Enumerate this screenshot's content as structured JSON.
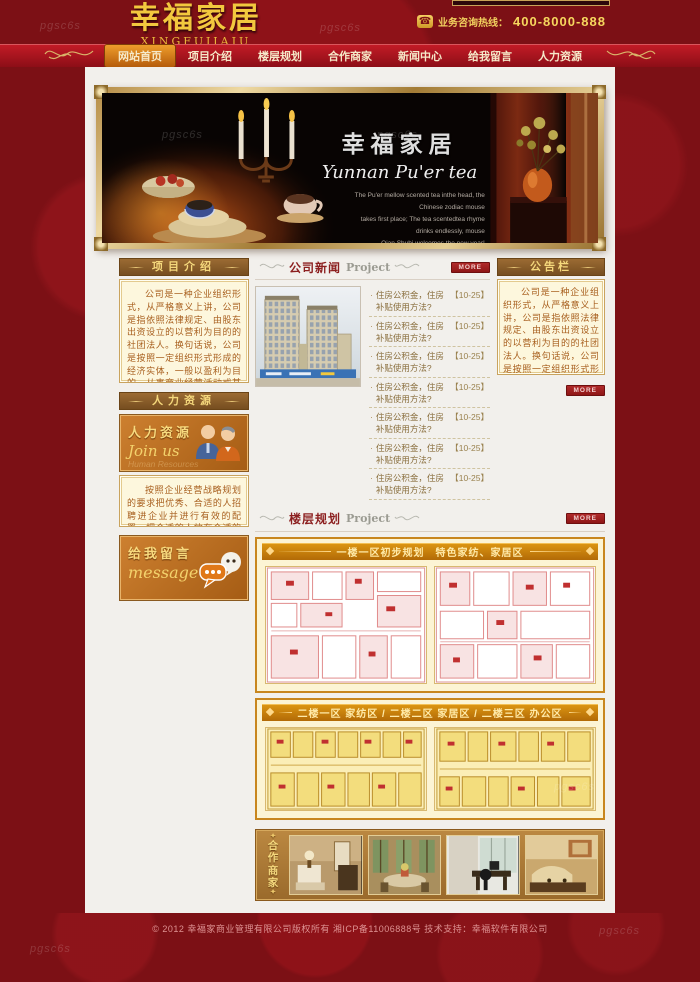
{
  "watermark": "pgsc6s",
  "header": {
    "logo_title": "幸福家居",
    "logo_subtitle": "XINGFUJIAJU",
    "phone_icon": "phone-icon",
    "hotline_label": "业务咨询热线：",
    "hotline_number": "400-8000-888"
  },
  "nav": {
    "items": [
      {
        "label": "网站首页",
        "active": true
      },
      {
        "label": "项目介绍",
        "active": false
      },
      {
        "label": "楼层规划",
        "active": false
      },
      {
        "label": "合作商家",
        "active": false
      },
      {
        "label": "新闻中心",
        "active": false
      },
      {
        "label": "给我留言",
        "active": false
      },
      {
        "label": "人力资源",
        "active": false
      }
    ]
  },
  "banner": {
    "title": "幸福家居",
    "subtitle": "Yunnan Pu'er tea",
    "lines": [
      "The Pu'er mellow scented tea inthe head, the",
      "Chinese zodiac mouse",
      "takes first place; The tea scentedtea rhyme",
      "drinks endlessly, mouse",
      "Qian Shubi welcomes the new year!"
    ]
  },
  "left": {
    "intro_title": "项目介绍",
    "intro_body": "公司是一种企业组织形式，从严格意义上讲，公司是指依照法律规定、由股东出资设立的以营利为目的的社团法人。换句话说，公司是按照一定组织形式形成的经济实体，一般以盈利为目的，从事商业经营活动或某些目的而成立的组织，以实现投资人利益最大化为使命，通过提供产品或服务换取收入。它是社会",
    "hr_title": "人力资源",
    "join_title": "人力资源",
    "join_subtitle": "Join us",
    "join_ghost": "Human Resources",
    "hr_body": "按照企业经营战略规划的要求把优秀、合适的人招聘进企业并进行有效的配置，把合适的人放在合适的岗位。工作内容...",
    "message_title": "给我留言",
    "message_subtitle": "message"
  },
  "news": {
    "title": "公司新闻",
    "title_en": "Project",
    "more_label": "MORE",
    "items": [
      {
        "text": "住房公积金，住房补贴使用方法?",
        "date": "【10-25】"
      },
      {
        "text": "住房公积金，住房补贴使用方法?",
        "date": "【10-25】"
      },
      {
        "text": "住房公积金，住房补贴使用方法?",
        "date": "【10-25】"
      },
      {
        "text": "住房公积金，住房补贴使用方法?",
        "date": "【10-25】"
      },
      {
        "text": "住房公积金，住房补贴使用方法?",
        "date": "【10-25】"
      },
      {
        "text": "住房公积金，住房补贴使用方法?",
        "date": "【10-25】"
      },
      {
        "text": "住房公积金，住房补贴使用方法?",
        "date": "【10-25】"
      }
    ]
  },
  "notice": {
    "title": "公告栏",
    "more_label": "MORE",
    "body": "公司是一种企业组织形式，从严格意义上讲，公司是指依照法律规定、由股东出资设立的以营利为目的的社团法人。换句话说，公司是按照一定组织形式形成的经济实体，一般以盈利为目的，从事商业经营活动或某些目的而成立的组织，以实现投资人利益最大化为使命"
  },
  "floorplan": {
    "title": "楼层规划",
    "title_en": "Project",
    "more_label": "MORE",
    "section1_title": "一楼一区初步规划　特色家纺、家居区",
    "section2_title": "二楼一区 家纺区 / 二楼二区 家居区 / 二楼三区 办公区"
  },
  "partners": {
    "title_chars": [
      "合",
      "作",
      "商",
      "家"
    ]
  },
  "footer": {
    "copyright": "© 2012 幸福家商业管理有限公司版权所有 湘ICP备11006888号 技术支持：幸福软件有限公司"
  },
  "colors": {
    "brand_red": "#7c1015",
    "nav_red": "#a01420",
    "active_orange": "#d07a18",
    "gold": "#f2c83e",
    "panel_cream": "#fdf7dd",
    "panel_border": "#c9a35e",
    "section_brown": "#8a5e2a",
    "more_red": "#a32222",
    "fp_orange": "#c8861e"
  }
}
